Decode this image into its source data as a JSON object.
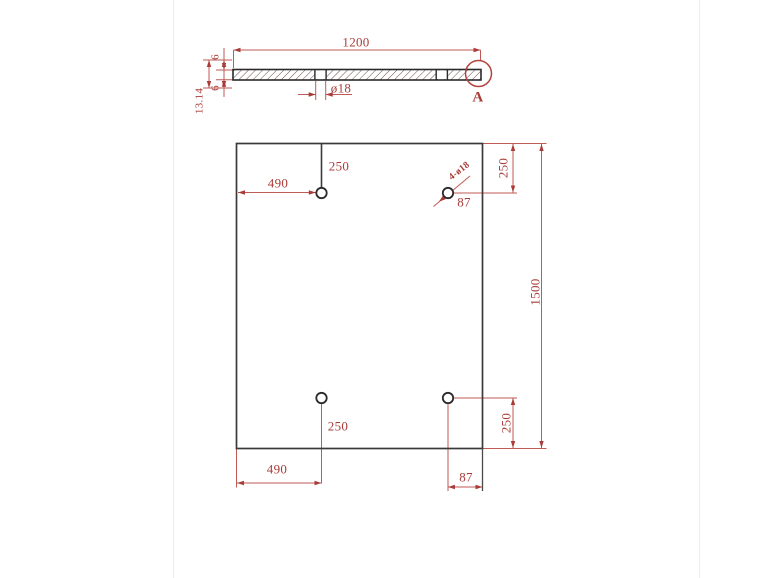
{
  "section_view": {
    "length_label": "1200",
    "top_plate_thickness_label": "6",
    "bottom_plate_thickness_label": "6",
    "overall_thickness_label": "13.14",
    "hole_diameter_label": "ø18",
    "detail_marker_label": "A"
  },
  "plan_view": {
    "height_label": "1500",
    "top_left_hole": {
      "from_top_label": "250",
      "from_left_label": "490"
    },
    "top_right_hole": {
      "note_label": "4-ø18",
      "from_right_label": "87",
      "from_top_label": "250"
    },
    "bottom_left_hole": {
      "from_bottom_label": "250",
      "from_left_label": "490"
    },
    "bottom_right_hole": {
      "from_bottom_label": "250",
      "from_right_label": "87"
    }
  },
  "colors": {
    "dimension_red": "#a93c38",
    "line_red": "#c05a54",
    "drawing_dark": "#3a3a3a"
  }
}
